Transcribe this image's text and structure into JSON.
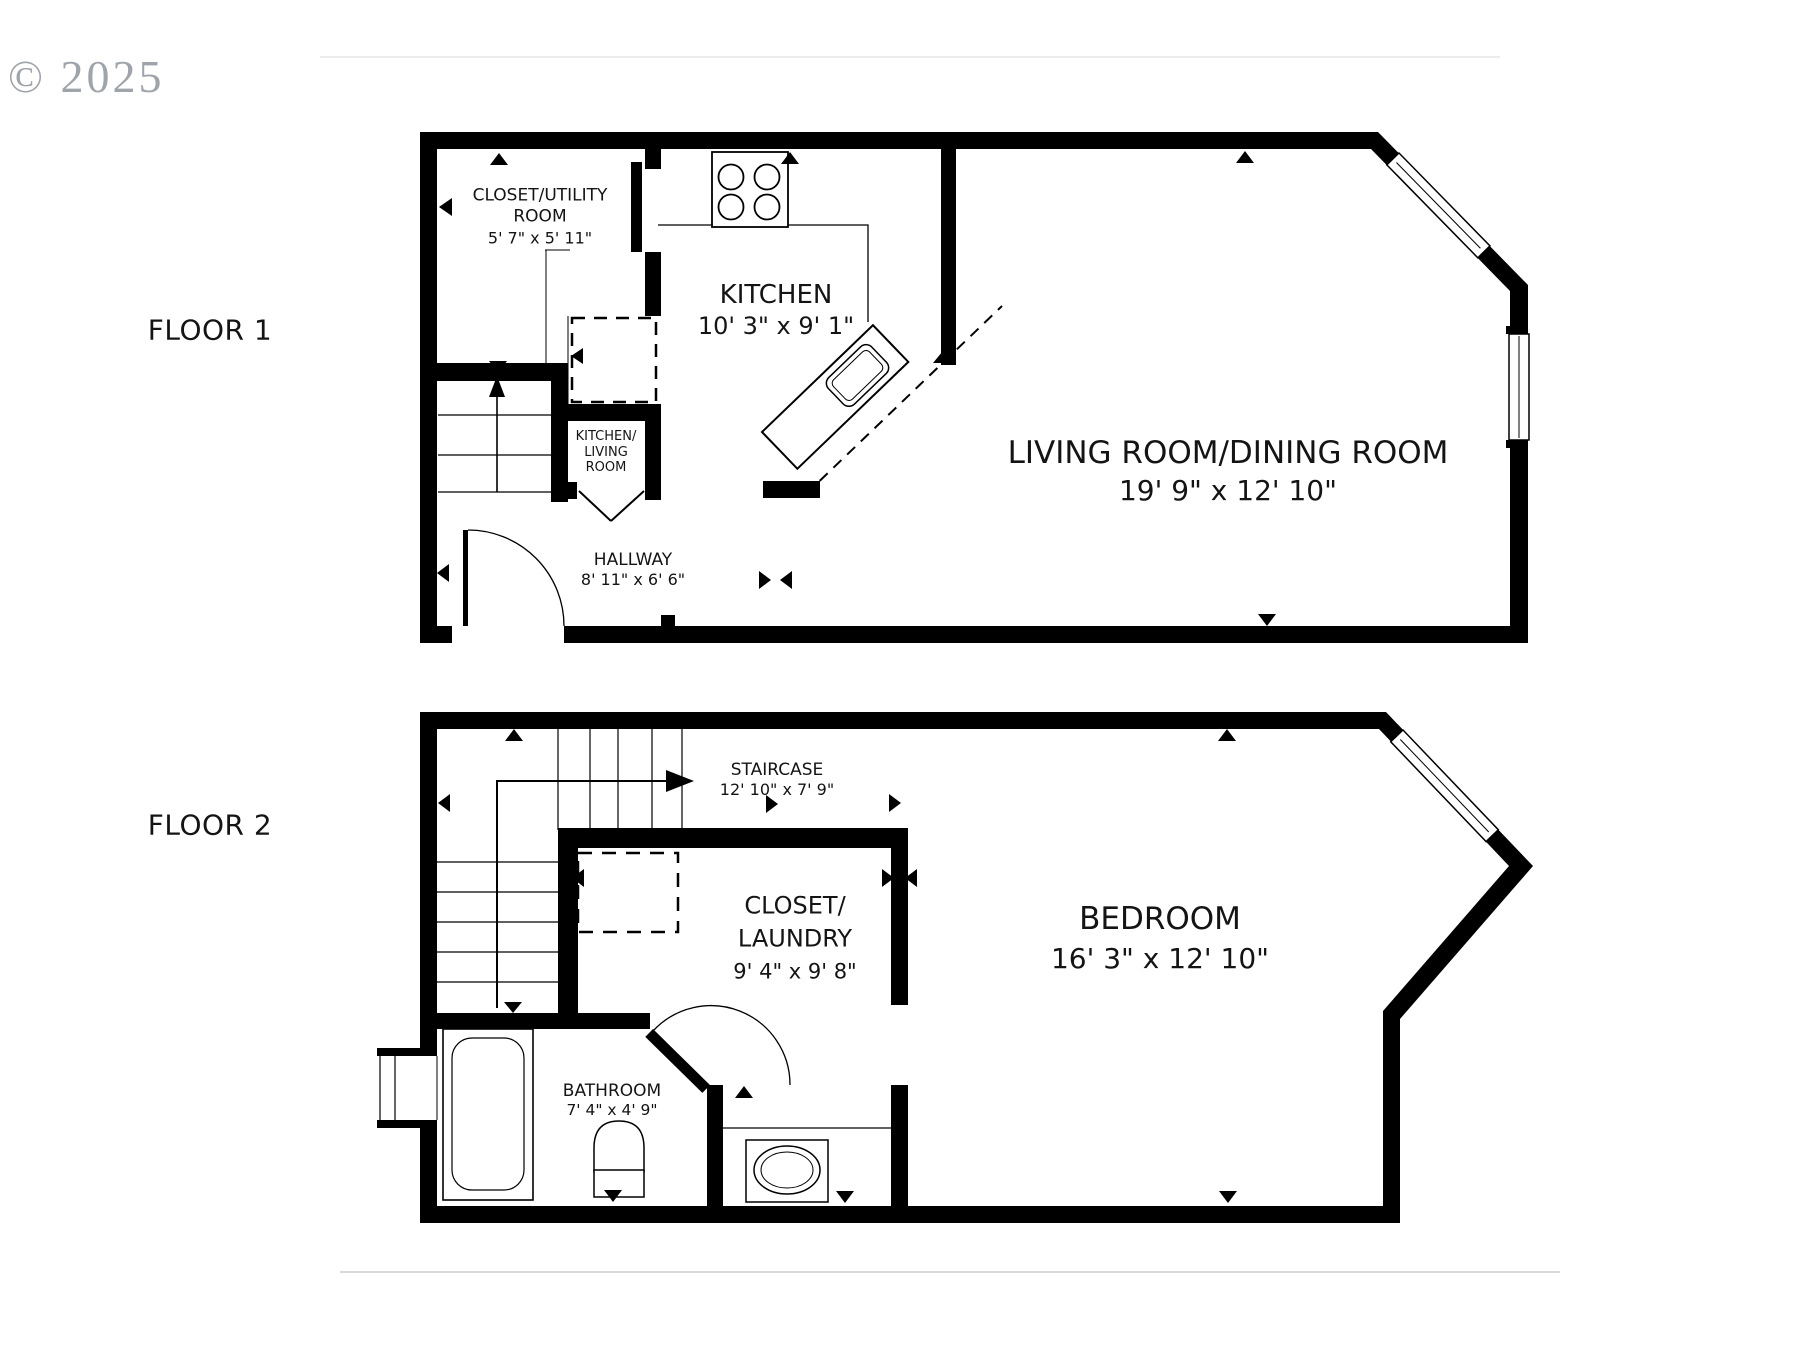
{
  "watermark": {
    "text": "© 2025"
  },
  "floor1": {
    "label": "FLOOR 1",
    "closet_utility": {
      "line1": "CLOSET/UTILITY",
      "line2": "ROOM",
      "dims": "5' 7\" x 5' 11\""
    },
    "kitchen": {
      "name": "KITCHEN",
      "dims": "10' 3\" x 9' 1\""
    },
    "living_dining": {
      "name": "LIVING ROOM/DINING ROOM",
      "dims": "19' 9\" x 12' 10\""
    },
    "pass_through": {
      "line1": "KITCHEN/",
      "line2": "LIVING",
      "line3": "ROOM"
    },
    "hallway": {
      "name": "HALLWAY",
      "dims": "8' 11\" x 6' 6\""
    }
  },
  "floor2": {
    "label": "FLOOR 2",
    "staircase": {
      "name": "STAIRCASE",
      "dims": "12' 10\" x 7' 9\""
    },
    "closet_laundry": {
      "line1": "CLOSET/",
      "line2": "LAUNDRY",
      "dims": "9' 4\" x 9' 8\""
    },
    "bedroom": {
      "name": "BEDROOM",
      "dims": "16' 3\" x 12' 10\""
    },
    "bathroom": {
      "name": "BATHROOM",
      "dims": "7' 4\" x 4' 9\""
    }
  },
  "colors": {
    "wall": "#000000",
    "text": "#141414",
    "watermark_gray": "#8f959d",
    "divider_gray": "#e0e0e0"
  }
}
